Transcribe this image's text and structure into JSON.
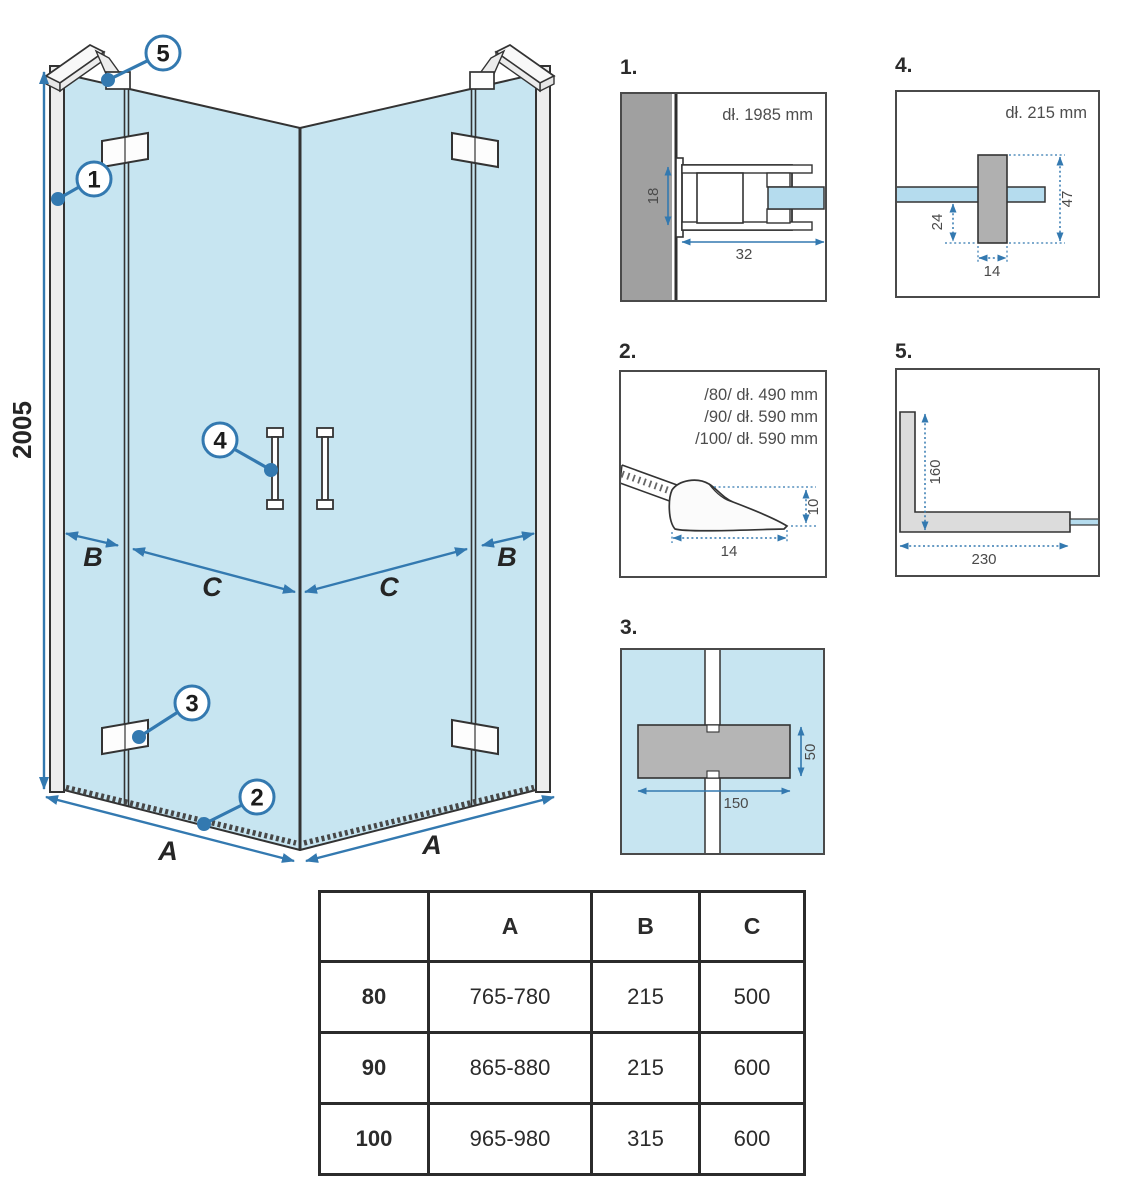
{
  "colors": {
    "accent_blue": "#3379b0",
    "glass_blue": "#c7e5f1",
    "glass_strip": "#b5dcee",
    "wall_gray": "#a0a0a0",
    "hinge_gray": "#b5b5b5",
    "bracket_gray": "#dcdcdc",
    "line_dark": "#333333"
  },
  "main": {
    "height_label": "2005",
    "dim_a": "A",
    "dim_b": "B",
    "dim_c": "C",
    "callouts": {
      "c1": "1",
      "c2": "2",
      "c3": "3",
      "c4": "4",
      "c5": "5"
    }
  },
  "details": {
    "d1": {
      "label": "1.",
      "note": "dł. 1985 mm",
      "dim_height": "18",
      "dim_width": "32"
    },
    "d2": {
      "label": "2.",
      "notes": [
        "/80/ dł. 490 mm",
        "/90/ dł. 590 mm",
        "/100/ dł. 590 mm"
      ],
      "dim_height": "10",
      "dim_width": "14"
    },
    "d3": {
      "label": "3.",
      "dim_width": "150",
      "dim_height": "50"
    },
    "d4": {
      "label": "4.",
      "note": "dł. 215 mm",
      "dim_height": "47",
      "dim_below": "24",
      "dim_width": "14"
    },
    "d5": {
      "label": "5.",
      "dim_height": "160",
      "dim_width": "230"
    }
  },
  "table": {
    "headers": [
      "A",
      "B",
      "C"
    ],
    "rows": [
      {
        "size": "80",
        "A": "765-780",
        "B": "215",
        "C": "500"
      },
      {
        "size": "90",
        "A": "865-880",
        "B": "215",
        "C": "600"
      },
      {
        "size": "100",
        "A": "965-980",
        "B": "315",
        "C": "600"
      }
    ]
  }
}
